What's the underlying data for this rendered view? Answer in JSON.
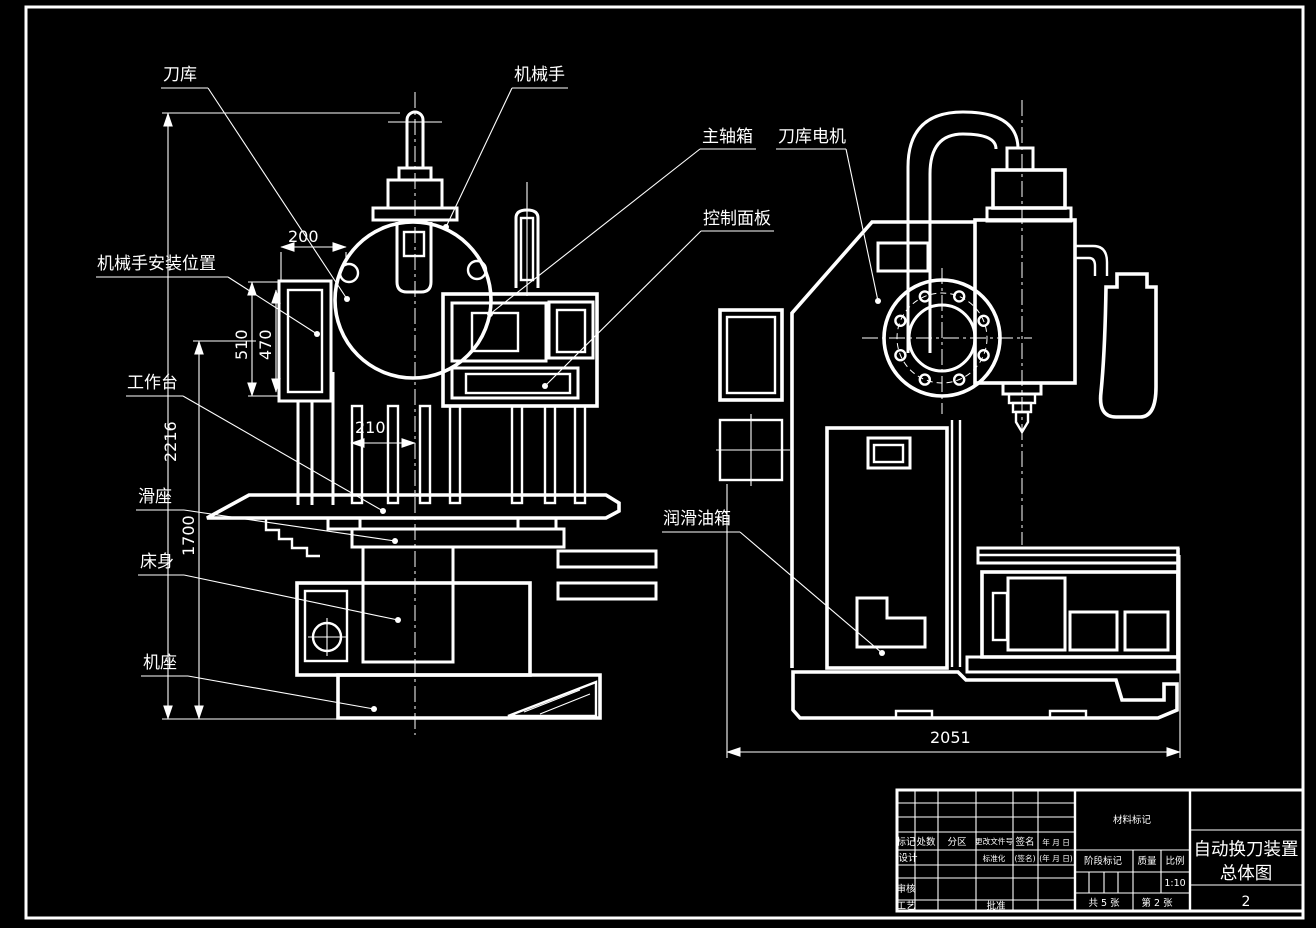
{
  "labels": {
    "tool_magazine": "刀库",
    "manipulator": "机械手",
    "spindle_box": "主轴箱",
    "magazine_motor": "刀库电机",
    "control_panel": "控制面板",
    "manipulator_mount_position": "机械手安装位置",
    "worktable": "工作台",
    "saddle": "滑座",
    "bed": "床身",
    "base": "机座",
    "lube_tank": "润滑油箱"
  },
  "dimensions": {
    "width_200": "200",
    "height_510": "510",
    "height_470": "470",
    "height_2216": "2216",
    "height_1700": "1700",
    "width_210": "210",
    "width_2051": "2051"
  },
  "title_block": {
    "material_mark": "材料标记",
    "mark": "标记",
    "count": "处数",
    "zone": "分区",
    "change_file_no": "更改文件号",
    "signature": "签名",
    "date": "年 月 日",
    "design": "设计",
    "standardization": "标准化",
    "signature_paren": "(签名)",
    "date_paren": "(年 月 日)",
    "stage_mark": "阶段标记",
    "weight": "质量",
    "scale": "比例",
    "scale_value": "1:10",
    "check": "审核",
    "process": "工艺",
    "approve": "批准",
    "total_sheets": "共 5 张",
    "sheet_number": "第 2 张",
    "title_line1": "自动换刀装置",
    "title_line2": "总体图",
    "drawing_no": "2"
  },
  "colors": {
    "background": "#000000",
    "line": "#ffffff"
  }
}
